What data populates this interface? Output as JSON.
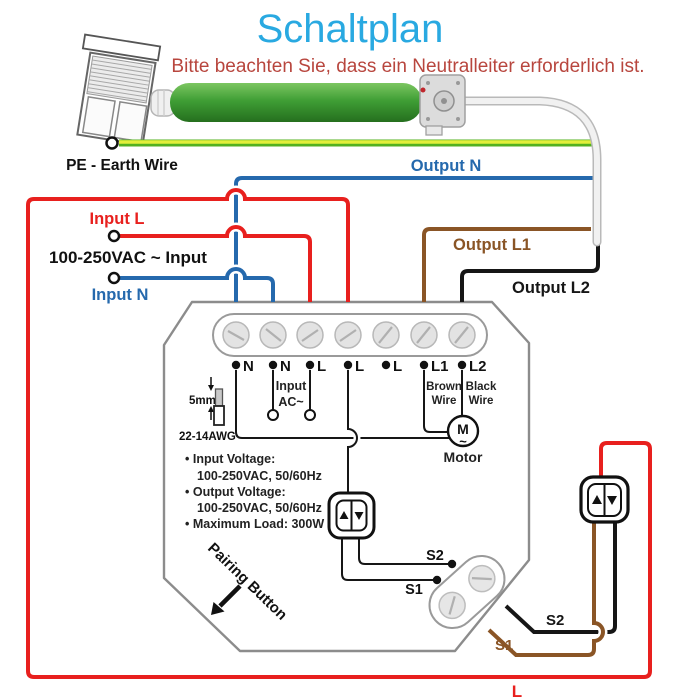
{
  "page": {
    "title": "Schaltplan",
    "subtitle": "Bitte beachten Sie, dass ein Neutralleiter erforderlich ist."
  },
  "colors": {
    "title_blue": "#29a9e1",
    "warning_red": "#b8463e",
    "live_red": "#e8201e",
    "neutral_blue": "#2569ad",
    "earth_green": "#54b120",
    "earth_yellow": "#e3ef3b",
    "brown_wire": "#8a5526",
    "black_wire": "#161616",
    "motor_green": "#3f9e35"
  },
  "wires": {
    "pe_label": "PE - Earth Wire",
    "output_n": "Output N",
    "input_l": "Input L",
    "ac_input": "100-250VAC ~ Input",
    "input_n": "Input N",
    "output_l1": "Output L1",
    "output_l2": "Output L2",
    "live_bottom": "L"
  },
  "module": {
    "terminals": [
      "N",
      "N",
      "L",
      "L",
      "L",
      "L1",
      "L2"
    ],
    "input_ac": {
      "line1": "Input",
      "line2": "AC~"
    },
    "l1_wire": {
      "line1": "Brown",
      "line2": "Wire"
    },
    "l2_wire": {
      "line1": "Black",
      "line2": "Wire"
    },
    "strip_length": "5mm",
    "wire_gauge": "22-14AWG",
    "specs": [
      "• Input Voltage:",
      "100-250VAC, 50/60Hz",
      "• Output Voltage:",
      "100-250VAC, 50/60Hz",
      "• Maximum Load: 300W"
    ],
    "motor": {
      "letter": "M",
      "tilde": "~",
      "label": "Motor"
    },
    "pairing_button": "Pairing Button",
    "s1": "S1",
    "s2": "S2"
  },
  "external_switch": {
    "s1": "S1",
    "s2": "S2"
  }
}
